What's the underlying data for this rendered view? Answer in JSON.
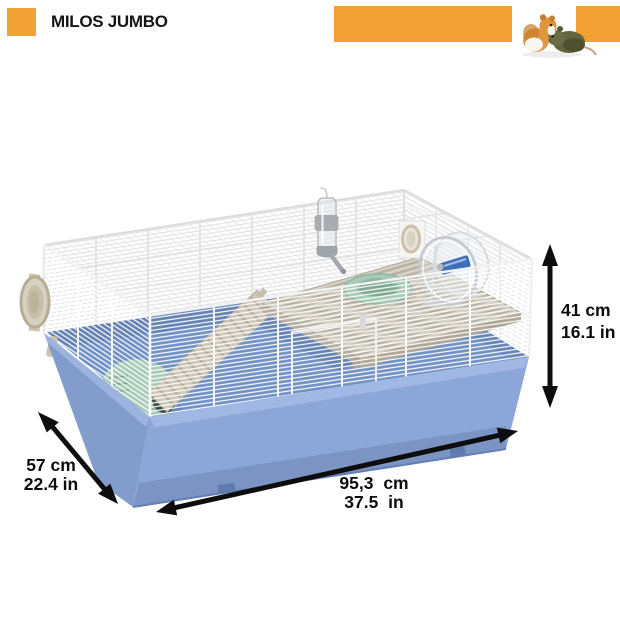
{
  "header": {
    "title": "MILOS JUMBO"
  },
  "dimensions": {
    "height": {
      "value_cm": "41 cm",
      "value_in": "16.1 in"
    },
    "depth": {
      "value_cm": "57 cm",
      "value_in": "22.4 in"
    },
    "width": {
      "value_cm": "95,3 cm",
      "value_in": "37.5 in"
    }
  },
  "illustration": {
    "objects": [
      "wire-cage-top",
      "blue-base-tub",
      "mezzanine-platform",
      "ladder-ramp",
      "green-house",
      "green-food-bowl",
      "water-bottle",
      "exercise-wheel",
      "side-door-port",
      "back-wall-port",
      "two-hamsters-photo"
    ]
  },
  "colors": {
    "accent": "#F2A235",
    "base-blue": "#8BA6D7",
    "floor-blue": "#7190C3",
    "platform-gray": "#C6C0B4",
    "accessory-green": "#A7CBB8",
    "ladder-beige": "#CFC8BA",
    "arrow-black": "#0D0D0D"
  }
}
